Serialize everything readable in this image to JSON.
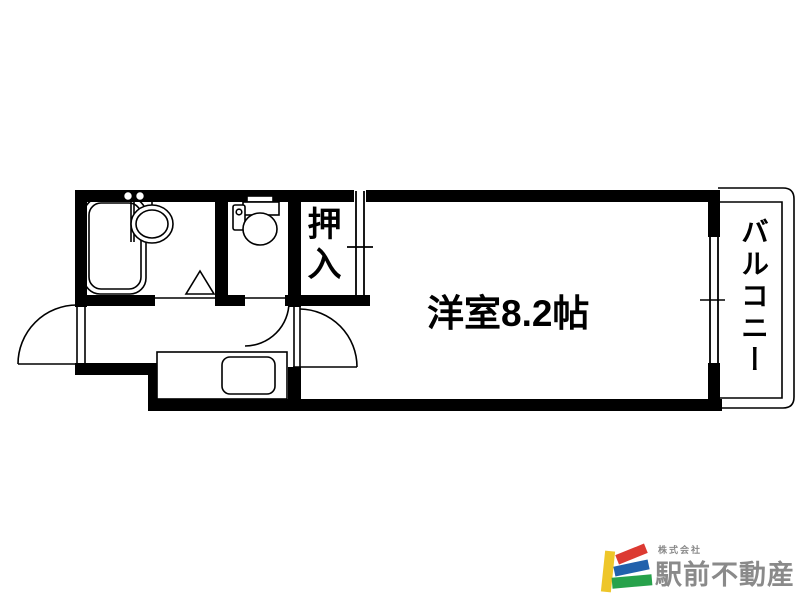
{
  "floor_plan": {
    "main_room_label": "洋室8.2帖",
    "closet_label": "押入",
    "balcony_label": "バルコニー",
    "fixtures": [
      "bathtub",
      "washbasin",
      "toilet",
      "kitchen-sink",
      "kitchen-counter"
    ],
    "doors": [
      "entrance-swing-door",
      "bathroom-folding-door",
      "toilet-swing-door",
      "main-room-swing-door",
      "closet-sliding-door",
      "balcony-window"
    ],
    "line_color": "#000000",
    "background_color": "#ffffff"
  },
  "logo": {
    "company_prefix": "株式会社",
    "company_name": "駅前不動産",
    "text_color": "#8a8a8a",
    "mark_colors": {
      "yellow": "#eec62a",
      "red": "#dc3a32",
      "blue": "#2161ac",
      "green": "#27a24b"
    }
  }
}
